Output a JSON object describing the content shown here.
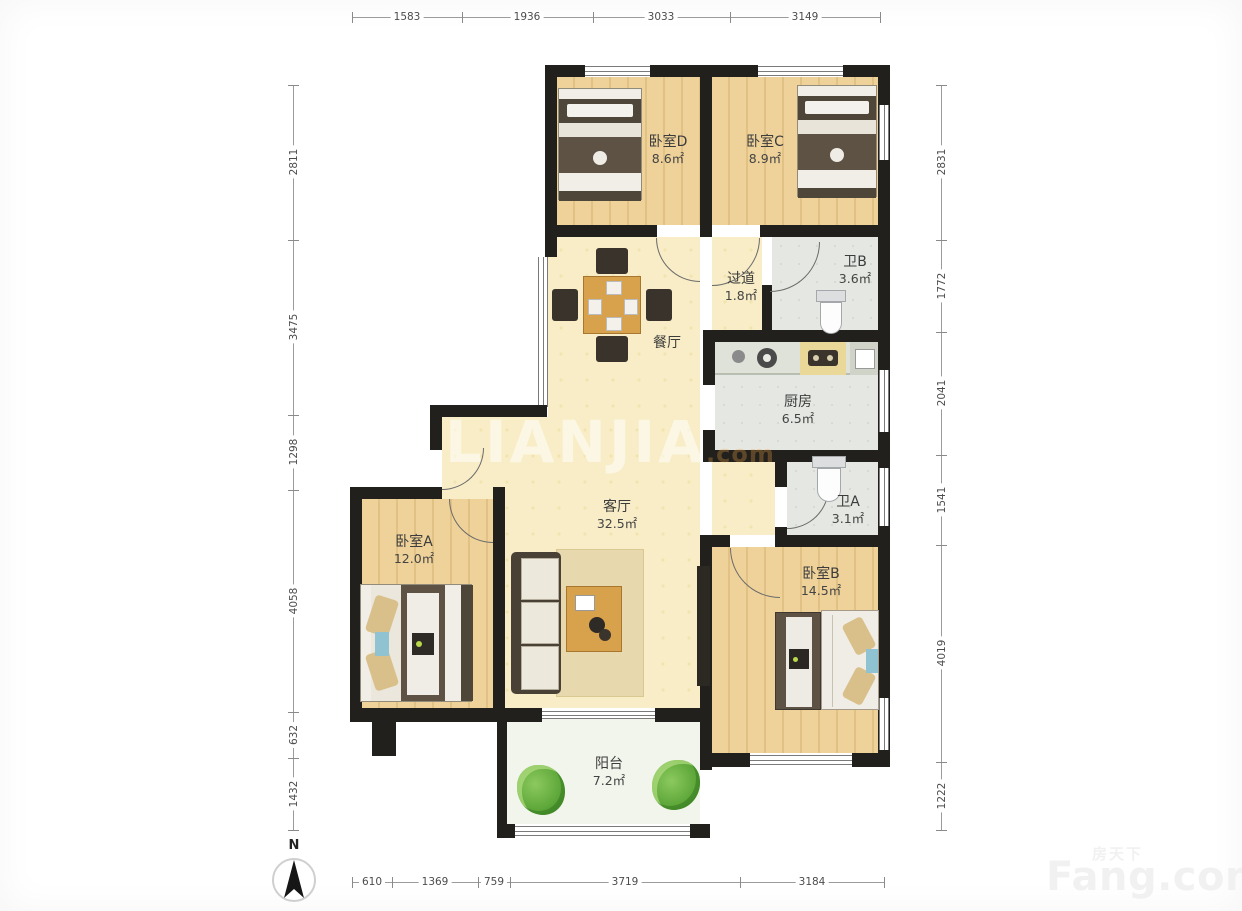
{
  "compass": {
    "label": "N"
  },
  "watermarks": {
    "center_main": "LIANJIA",
    "center_suffix": ".com",
    "brand_cn": "房天下",
    "brand_en": "Fang.com"
  },
  "dimensions": {
    "top": [
      "1583",
      "1936",
      "3033",
      "3149"
    ],
    "bottom": [
      "610",
      "1369",
      "759",
      "3719",
      "3184"
    ],
    "left": [
      "2811",
      "3475",
      "1298",
      "4058",
      "632",
      "1432"
    ],
    "right": [
      "2831",
      "1772",
      "2041",
      "1541",
      "4019",
      "1222"
    ]
  },
  "rooms": [
    {
      "id": "bedroom-d",
      "name": "卧室D",
      "area": "8.6㎡"
    },
    {
      "id": "bedroom-c",
      "name": "卧室C",
      "area": "8.9㎡"
    },
    {
      "id": "hallway",
      "name": "过道",
      "area": "1.8㎡"
    },
    {
      "id": "bathroom-b",
      "name": "卫B",
      "area": "3.6㎡"
    },
    {
      "id": "dining",
      "name": "餐厅",
      "area": ""
    },
    {
      "id": "kitchen",
      "name": "厨房",
      "area": "6.5㎡"
    },
    {
      "id": "bathroom-a",
      "name": "卫A",
      "area": "3.1㎡"
    },
    {
      "id": "living",
      "name": "客厅",
      "area": "32.5㎡"
    },
    {
      "id": "bedroom-a",
      "name": "卧室A",
      "area": "12.0㎡"
    },
    {
      "id": "bedroom-b",
      "name": "卧室B",
      "area": "14.5㎡"
    },
    {
      "id": "balcony",
      "name": "阳台",
      "area": "7.2㎡"
    }
  ],
  "colors": {
    "wall": "#22201d",
    "wood_floor": "#eed29a",
    "cream_floor": "#f8edc6",
    "tile_floor": "#e5e8e2",
    "balcony_floor": "#f2f5ec",
    "plant_green": "#5fae3a",
    "accent_blue": "#8fc3d1",
    "dimension_text": "#4c4c4c"
  }
}
